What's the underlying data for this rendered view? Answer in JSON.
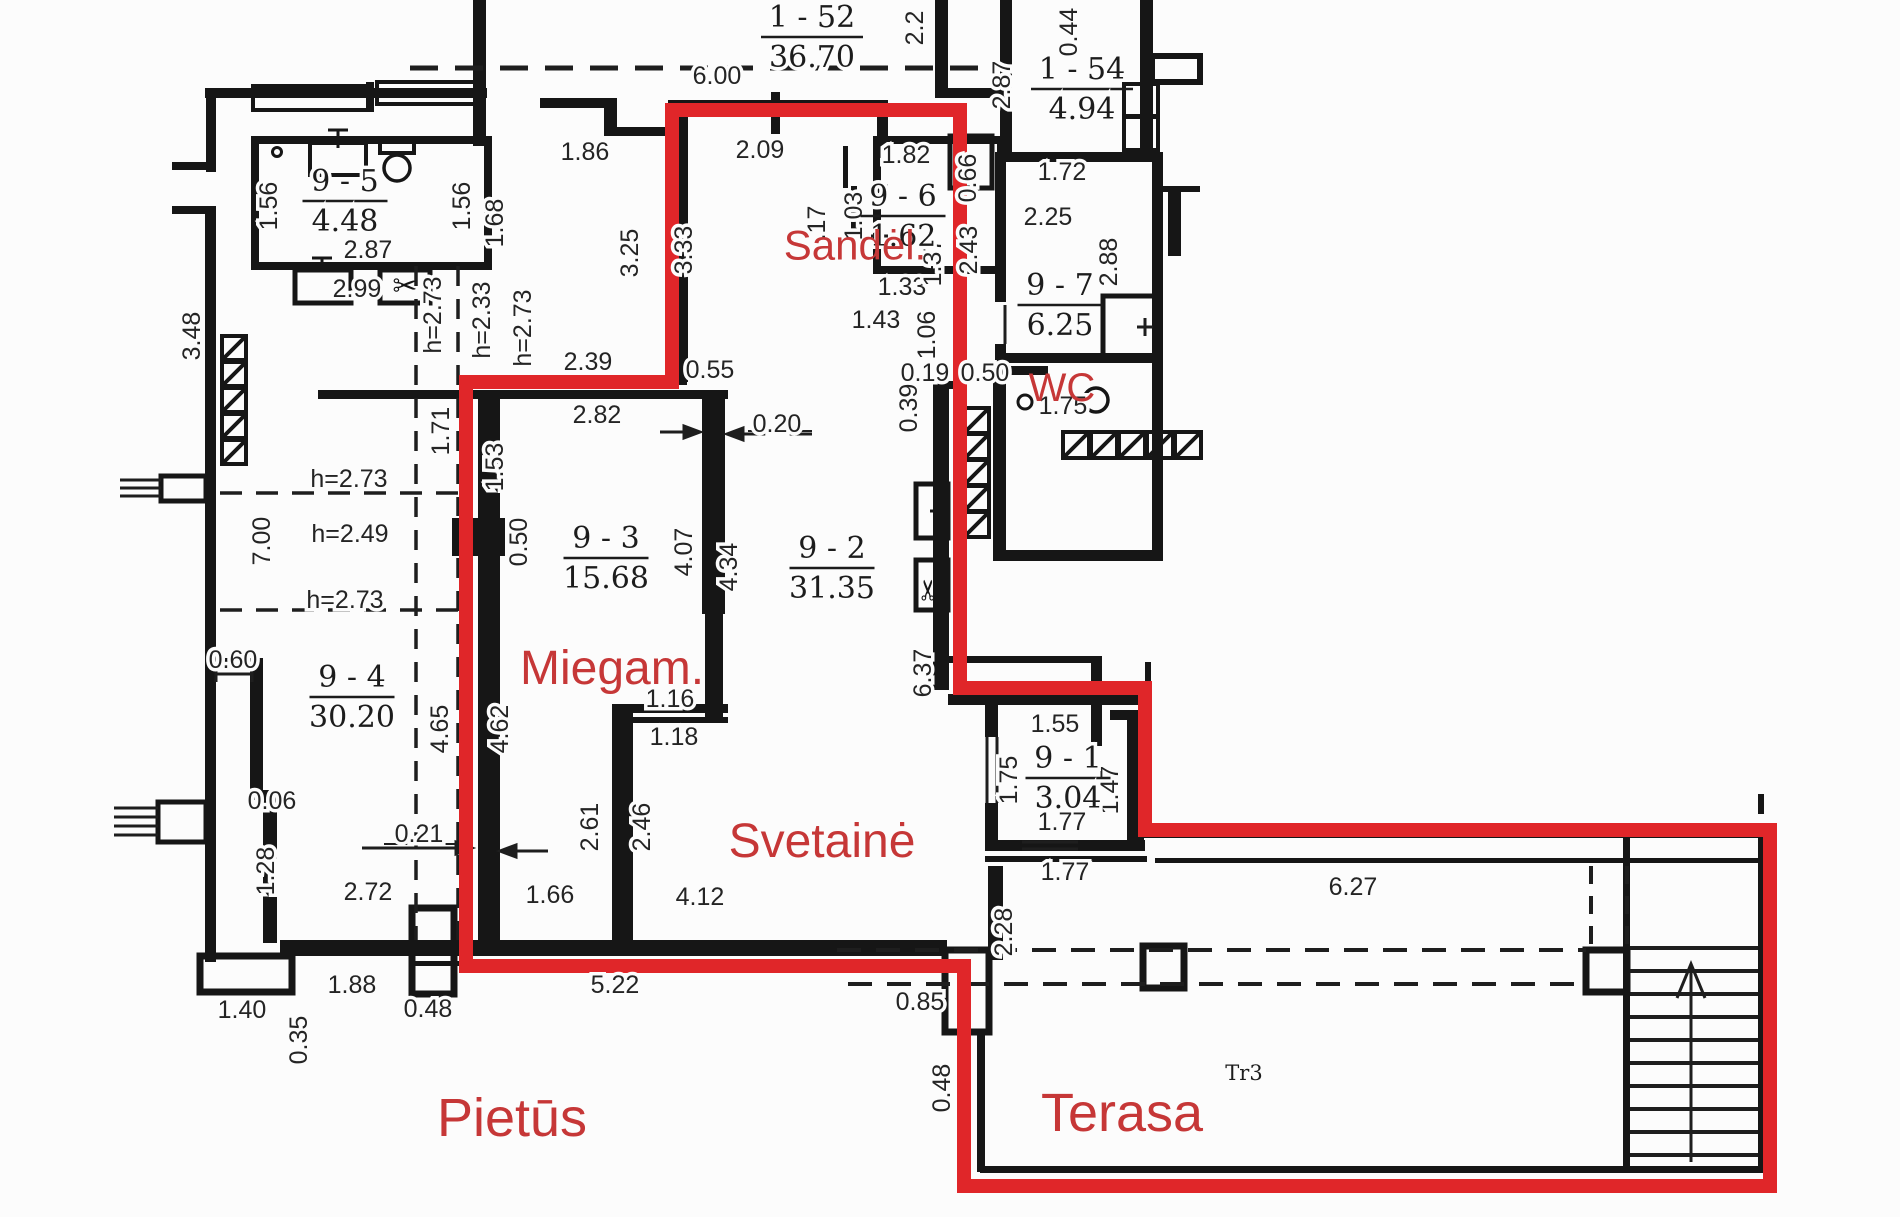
{
  "colors": {
    "wall": "#161616",
    "thin_line": "#1e1e1e",
    "dim_text": "#242424",
    "red_outline": "#e02629",
    "red_text": "#c63737",
    "background": "#fcfcfc"
  },
  "room_names": [
    {
      "label": "Sandėl.",
      "x": 855,
      "y": 245,
      "size": 42
    },
    {
      "label": "WC",
      "x": 1062,
      "y": 387,
      "size": 40
    },
    {
      "label": "Miegam.",
      "x": 612,
      "y": 667,
      "size": 48
    },
    {
      "label": "Svetainė",
      "x": 822,
      "y": 840,
      "size": 48
    },
    {
      "label": "Pietūs",
      "x": 512,
      "y": 1117,
      "size": 54
    },
    {
      "label": "Terasa",
      "x": 1122,
      "y": 1112,
      "size": 54
    }
  ],
  "area_labels": [
    {
      "code": "1 - 52",
      "area": "36.70",
      "x": 812,
      "y": 33
    },
    {
      "code": "1 - 54",
      "area": "4.94",
      "x": 1082,
      "y": 85
    },
    {
      "code": "9 - 5",
      "area": "4.48",
      "x": 345,
      "y": 197
    },
    {
      "code": "9 - 6",
      "area": "1.62",
      "x": 903,
      "y": 212
    },
    {
      "code": "9 - 7",
      "area": "6.25",
      "x": 1060,
      "y": 301
    },
    {
      "code": "9 - 3",
      "area": "15.68",
      "x": 606,
      "y": 554
    },
    {
      "code": "9 - 2",
      "area": "31.35",
      "x": 832,
      "y": 564
    },
    {
      "code": "9 - 4",
      "area": "30.20",
      "x": 352,
      "y": 693
    },
    {
      "code": "9 - 1",
      "area": "3.04",
      "x": 1068,
      "y": 774
    }
  ],
  "dimensions": [
    {
      "text": "6.00",
      "x": 717,
      "y": 76
    },
    {
      "text": "1.86",
      "x": 585,
      "y": 152
    },
    {
      "text": "2.09",
      "x": 760,
      "y": 150
    },
    {
      "text": "1.82",
      "x": 906,
      "y": 155
    },
    {
      "text": "1.72",
      "x": 1062,
      "y": 172
    },
    {
      "text": "2.25",
      "x": 1048,
      "y": 217
    },
    {
      "text": "2.87",
      "x": 368,
      "y": 250
    },
    {
      "text": "2.99",
      "x": 357,
      "y": 289
    },
    {
      "text": "1.33",
      "x": 902,
      "y": 287
    },
    {
      "text": "1.43",
      "x": 876,
      "y": 320
    },
    {
      "text": "2.39",
      "x": 588,
      "y": 362
    },
    {
      "text": "0.55",
      "x": 710,
      "y": 370
    },
    {
      "text": "0.19",
      "x": 925,
      "y": 373
    },
    {
      "text": "0.50",
      "x": 985,
      "y": 373
    },
    {
      "text": "2.82",
      "x": 597,
      "y": 415
    },
    {
      "text": "0.20",
      "x": 777,
      "y": 424
    },
    {
      "text": "1.75",
      "x": 1063,
      "y": 406
    },
    {
      "text": "h=2.73",
      "x": 349,
      "y": 479
    },
    {
      "text": "h=2.49",
      "x": 350,
      "y": 534
    },
    {
      "text": "h=2.73",
      "x": 345,
      "y": 600
    },
    {
      "text": "1.16",
      "x": 670,
      "y": 699
    },
    {
      "text": "1.18",
      "x": 674,
      "y": 737
    },
    {
      "text": "1.55",
      "x": 1055,
      "y": 724
    },
    {
      "text": "1.77",
      "x": 1062,
      "y": 822
    },
    {
      "text": "1.77",
      "x": 1065,
      "y": 872
    },
    {
      "text": "6.27",
      "x": 1353,
      "y": 887
    },
    {
      "text": "2.72",
      "x": 368,
      "y": 892
    },
    {
      "text": "0.21",
      "x": 419,
      "y": 834
    },
    {
      "text": "0.06",
      "x": 272,
      "y": 801
    },
    {
      "text": "0.60",
      "x": 233,
      "y": 660
    },
    {
      "text": "4.12",
      "x": 700,
      "y": 897
    },
    {
      "text": "1.66",
      "x": 550,
      "y": 895
    },
    {
      "text": "1.88",
      "x": 352,
      "y": 985
    },
    {
      "text": "1.40",
      "x": 242,
      "y": 1010
    },
    {
      "text": "0.48",
      "x": 428,
      "y": 1009
    },
    {
      "text": "5.22",
      "x": 615,
      "y": 985
    },
    {
      "text": "0.85",
      "x": 920,
      "y": 1002
    },
    {
      "text": "2.2",
      "x": 923,
      "y": 20,
      "rot": -90
    },
    {
      "text": "0.44",
      "x": 1077,
      "y": 24,
      "rot": -90
    },
    {
      "text": "2.87",
      "x": 1010,
      "y": 77,
      "rot": -90
    },
    {
      "text": "1.56",
      "x": 277,
      "y": 198,
      "rot": -90
    },
    {
      "text": "1.56",
      "x": 470,
      "y": 198,
      "rot": -90
    },
    {
      "text": "1.68",
      "x": 503,
      "y": 215,
      "rot": -90
    },
    {
      "text": "3.48",
      "x": 200,
      "y": 328,
      "rot": -90
    },
    {
      "text": "h=2.73",
      "x": 441,
      "y": 307,
      "rot": -90
    },
    {
      "text": "h=2.33",
      "x": 490,
      "y": 312,
      "rot": -90
    },
    {
      "text": "h=2.73",
      "x": 531,
      "y": 320,
      "rot": -90
    },
    {
      "text": "3.25",
      "x": 638,
      "y": 245,
      "rot": -90
    },
    {
      "text": "3.33",
      "x": 692,
      "y": 242,
      "rot": -90
    },
    {
      "text": ".17",
      "x": 825,
      "y": 215,
      "rot": -90
    },
    {
      "text": "1.03",
      "x": 862,
      "y": 208,
      "rot": -90
    },
    {
      "text": "1.37",
      "x": 941,
      "y": 254,
      "rot": -90
    },
    {
      "text": "2.43",
      "x": 977,
      "y": 242,
      "rot": -90
    },
    {
      "text": "1.06",
      "x": 935,
      "y": 327,
      "rot": -90
    },
    {
      "text": "0.39",
      "x": 917,
      "y": 400,
      "rot": -90
    },
    {
      "text": "0.66",
      "x": 976,
      "y": 170,
      "rot": -90
    },
    {
      "text": "2.88",
      "x": 1117,
      "y": 254,
      "rot": -90
    },
    {
      "text": "1.71",
      "x": 449,
      "y": 423,
      "rot": -90
    },
    {
      "text": "1.53",
      "x": 503,
      "y": 459,
      "rot": -90
    },
    {
      "text": "0.50",
      "x": 527,
      "y": 534,
      "rot": -90
    },
    {
      "text": "4.07",
      "x": 692,
      "y": 544,
      "rot": -90
    },
    {
      "text": "4.34",
      "x": 737,
      "y": 559,
      "rot": -90
    },
    {
      "text": "6.37",
      "x": 931,
      "y": 665,
      "rot": -90
    },
    {
      "text": "7.00",
      "x": 270,
      "y": 533,
      "rot": -90
    },
    {
      "text": "4.65",
      "x": 448,
      "y": 721,
      "rot": -90
    },
    {
      "text": "4.62",
      "x": 508,
      "y": 721,
      "rot": -90
    },
    {
      "text": "2.61",
      "x": 598,
      "y": 819,
      "rot": -90
    },
    {
      "text": "2.46",
      "x": 650,
      "y": 819,
      "rot": -90
    },
    {
      "text": "1.28",
      "x": 274,
      "y": 863,
      "rot": -90
    },
    {
      "text": "0.35",
      "x": 307,
      "y": 1032,
      "rot": -90
    },
    {
      "text": "1.75",
      "x": 1017,
      "y": 772,
      "rot": -90
    },
    {
      "text": "1.47",
      "x": 1118,
      "y": 782,
      "rot": -90
    },
    {
      "text": "2.28",
      "x": 1012,
      "y": 924,
      "rot": -90
    },
    {
      "text": "0.48",
      "x": 950,
      "y": 1080,
      "rot": -90
    }
  ],
  "annotations": [
    {
      "text": "Tr3",
      "x": 1244,
      "y": 1080
    }
  ]
}
